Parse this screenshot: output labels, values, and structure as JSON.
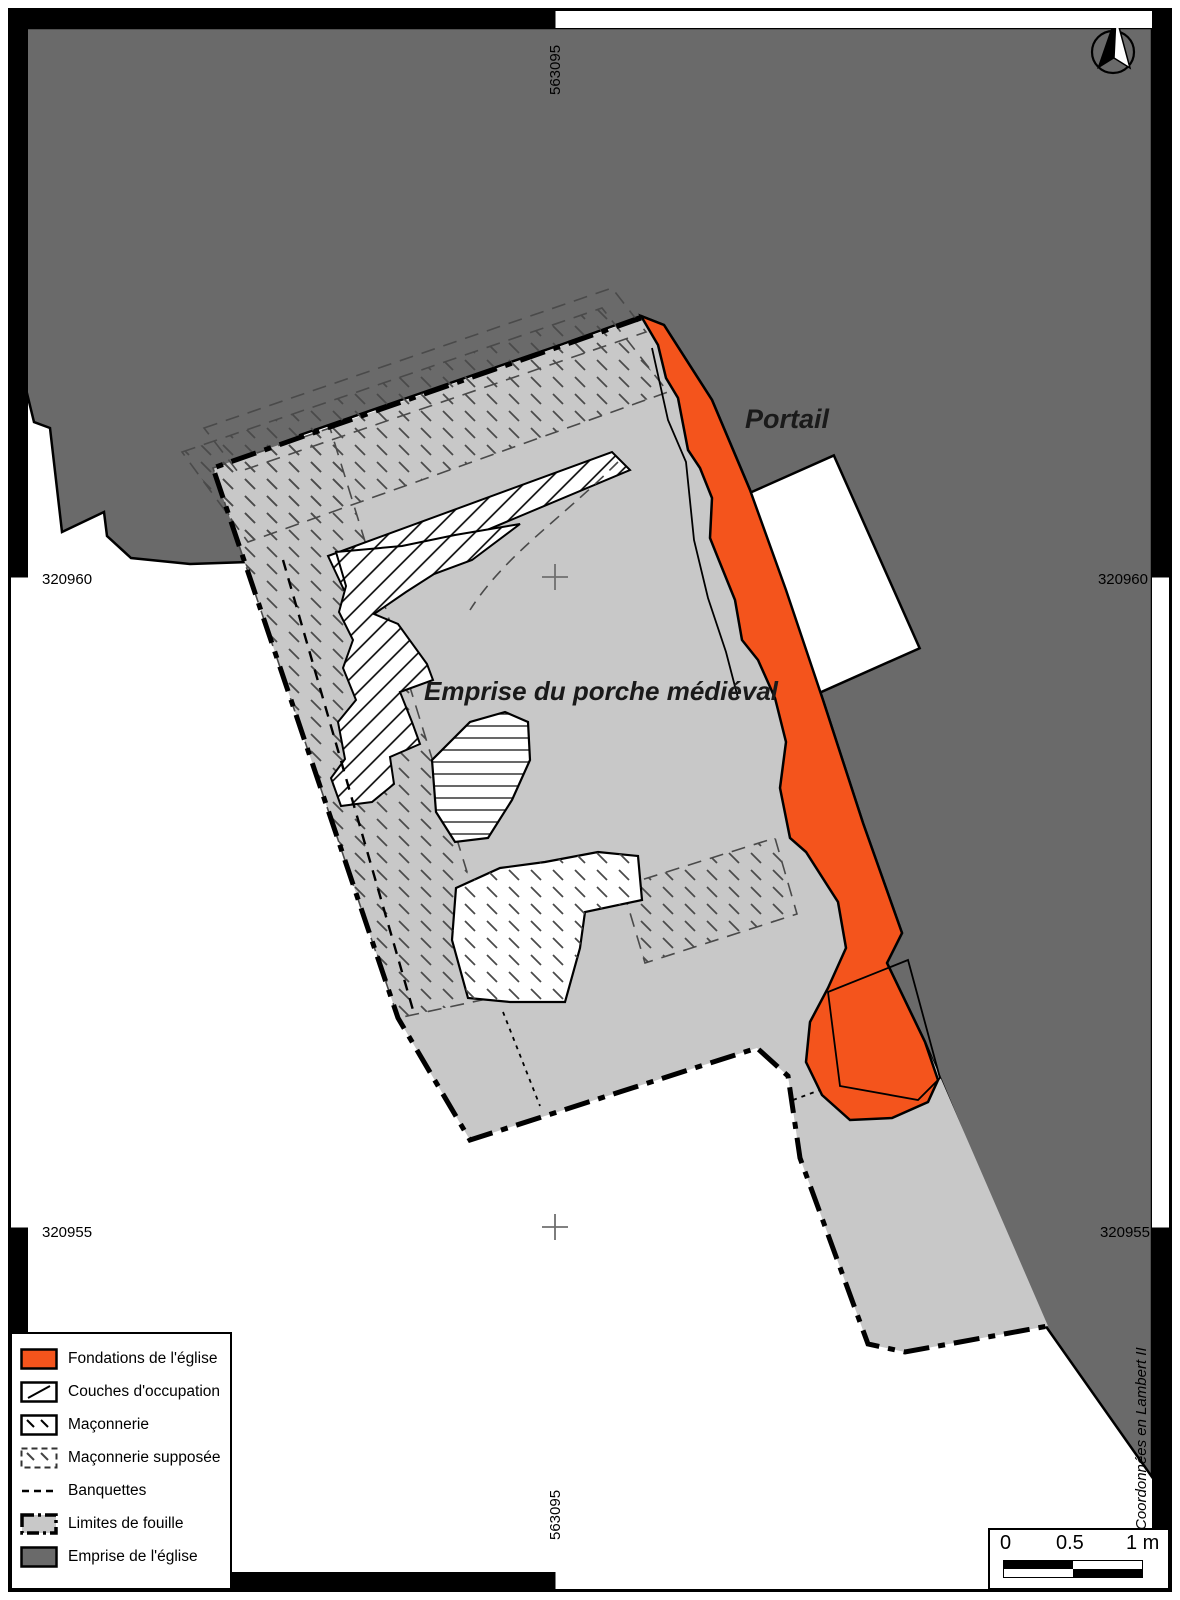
{
  "map": {
    "annotations": {
      "portail": "Portail",
      "emprise_porche": "Emprise du porche médiéval"
    },
    "grid": {
      "easting_top": "563095",
      "easting_bottom": "563095",
      "northing_upper_left": "320960",
      "northing_upper_right": "320960",
      "northing_lower_left": "320955",
      "northing_lower_right": "320955"
    },
    "north_label": "N",
    "credit": "Coordonnées en Lambert II",
    "colors": {
      "foundation_orange": "#f4541c",
      "church_dark_gray": "#6a6a6a",
      "excavation_light_gray": "#c8c8c8"
    }
  },
  "legend": {
    "items": [
      {
        "label": "Fondations de l'église",
        "swatch": "orange-fill"
      },
      {
        "label": "Couches d'occupation",
        "swatch": "diagonal-hatch"
      },
      {
        "label": "Maçonnerie",
        "swatch": "masonry-hatch"
      },
      {
        "label": "Maçonnerie supposée",
        "swatch": "masonry-dashed"
      },
      {
        "label": "Banquettes",
        "swatch": "dashed-line"
      },
      {
        "label": "Limites de fouille",
        "swatch": "gray-dashdot"
      },
      {
        "label": "Emprise de l'église",
        "swatch": "darkgray-fill"
      }
    ]
  },
  "scalebar": {
    "tick_0": "0",
    "tick_05": "0.5",
    "tick_1": "1 m"
  }
}
